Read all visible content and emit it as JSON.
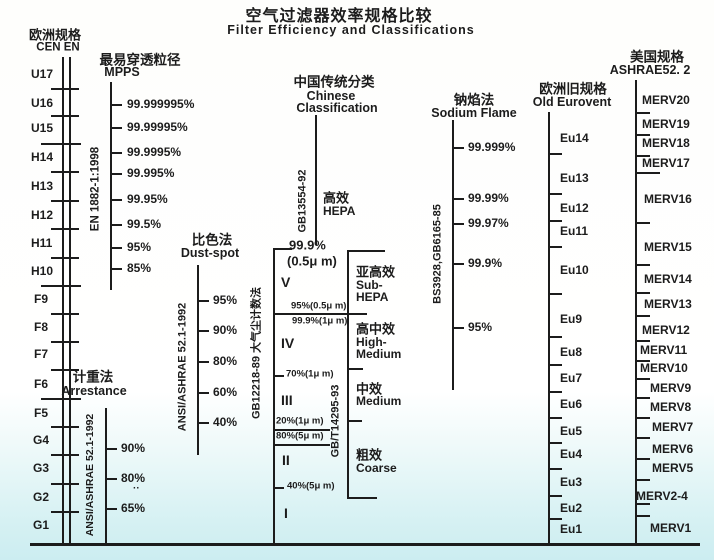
{
  "title": {
    "zh": "空气过滤器效率规格比较",
    "en": "Filter Efficiency and Classifications"
  },
  "colors": {
    "ink": "#1c1c1c",
    "bg_bottom": "#ccedf1",
    "bg_top": "#ffffff"
  },
  "baseline": {
    "y": 543,
    "x1": 30,
    "x2": 700
  },
  "scales": [
    {
      "id": "cen-en",
      "headers": [
        {
          "t": "欧洲规格",
          "cx": 55,
          "cy": 35,
          "s": 13
        },
        {
          "t": "CEN EN",
          "cx": 58,
          "cy": 48,
          "s": 11.5
        }
      ],
      "lines": [
        {
          "x": 62,
          "y1": 57,
          "y2": 543
        },
        {
          "x": 69,
          "y1": 57,
          "y2": 543
        }
      ],
      "labels": [
        {
          "t": "U17",
          "x": 31,
          "y": 74
        },
        {
          "t": "U16",
          "x": 31,
          "y": 103
        },
        {
          "t": "U15",
          "x": 31,
          "y": 128
        },
        {
          "t": "H14",
          "x": 31,
          "y": 157
        },
        {
          "t": "H13",
          "x": 31,
          "y": 186
        },
        {
          "t": "H12",
          "x": 31,
          "y": 215
        },
        {
          "t": "H11",
          "x": 31,
          "y": 243
        },
        {
          "t": "H10",
          "x": 31,
          "y": 271
        },
        {
          "t": "F9",
          "x": 34,
          "y": 299
        },
        {
          "t": "F8",
          "x": 34,
          "y": 327
        },
        {
          "t": "F7",
          "x": 34,
          "y": 354
        },
        {
          "t": "F6",
          "x": 34,
          "y": 384
        },
        {
          "t": "F5",
          "x": 34,
          "y": 413
        },
        {
          "t": "G4",
          "x": 33,
          "y": 440
        },
        {
          "t": "G3",
          "x": 33,
          "y": 468
        },
        {
          "t": "G2",
          "x": 33,
          "y": 497
        },
        {
          "t": "G1",
          "x": 33,
          "y": 525
        }
      ],
      "hlines": [
        {
          "y": 88,
          "x1": 51,
          "x2": 79
        },
        {
          "y": 115,
          "x1": 51,
          "x2": 79
        },
        {
          "y": 143,
          "x1": 41,
          "x2": 81
        },
        {
          "y": 171,
          "x1": 51,
          "x2": 79
        },
        {
          "y": 200,
          "x1": 51,
          "x2": 79
        },
        {
          "y": 228,
          "x1": 51,
          "x2": 79
        },
        {
          "y": 257,
          "x1": 51,
          "x2": 79
        },
        {
          "y": 285,
          "x1": 41,
          "x2": 81
        },
        {
          "y": 313,
          "x1": 51,
          "x2": 79
        },
        {
          "y": 341,
          "x1": 51,
          "x2": 79
        },
        {
          "y": 369,
          "x1": 51,
          "x2": 79
        },
        {
          "y": 398,
          "x1": 41,
          "x2": 81
        },
        {
          "y": 426,
          "x1": 51,
          "x2": 79
        },
        {
          "y": 454,
          "x1": 51,
          "x2": 79
        },
        {
          "y": 483,
          "x1": 51,
          "x2": 79
        },
        {
          "y": 511,
          "x1": 51,
          "x2": 79
        }
      ],
      "vtexts": []
    },
    {
      "id": "mpps",
      "headers": [
        {
          "t": "最易穿透粒径",
          "cx": 140,
          "cy": 60,
          "s": 13.5
        },
        {
          "t": "MPPS",
          "cx": 122,
          "cy": 72,
          "s": 12.5
        }
      ],
      "lines": [
        {
          "x": 110,
          "y1": 82,
          "y2": 290
        }
      ],
      "labels": [
        {
          "t": "99.999995%",
          "x": 127,
          "y": 104
        },
        {
          "t": "99.99995%",
          "x": 127,
          "y": 127
        },
        {
          "t": "99.9995%",
          "x": 127,
          "y": 152
        },
        {
          "t": "99.995%",
          "x": 127,
          "y": 173
        },
        {
          "t": "99.95%",
          "x": 127,
          "y": 199
        },
        {
          "t": "99.5%",
          "x": 127,
          "y": 224
        },
        {
          "t": "95%",
          "x": 127,
          "y": 247
        },
        {
          "t": "85%",
          "x": 127,
          "y": 268
        }
      ],
      "hlines": [
        {
          "y": 104,
          "x1": 110,
          "x2": 122
        },
        {
          "y": 127,
          "x1": 110,
          "x2": 122
        },
        {
          "y": 152,
          "x1": 110,
          "x2": 122
        },
        {
          "y": 173,
          "x1": 110,
          "x2": 122
        },
        {
          "y": 199,
          "x1": 110,
          "x2": 122
        },
        {
          "y": 224,
          "x1": 110,
          "x2": 122
        },
        {
          "y": 247,
          "x1": 110,
          "x2": 122
        },
        {
          "y": 268,
          "x1": 110,
          "x2": 122
        }
      ],
      "vtexts": [
        {
          "t": "EN 1882-1:1998",
          "cx": 96,
          "cy": 189,
          "s": 11.5
        }
      ]
    },
    {
      "id": "dust-spot",
      "headers": [
        {
          "t": "比色法",
          "cx": 212,
          "cy": 240,
          "s": 13.5
        },
        {
          "t": "Dust-spot",
          "cx": 210,
          "cy": 253,
          "s": 12.5
        }
      ],
      "lines": [
        {
          "x": 197,
          "y1": 265,
          "y2": 455
        }
      ],
      "labels": [
        {
          "t": "95%",
          "x": 213,
          "y": 300
        },
        {
          "t": "90%",
          "x": 213,
          "y": 330
        },
        {
          "t": "80%",
          "x": 213,
          "y": 361
        },
        {
          "t": "60%",
          "x": 213,
          "y": 392
        },
        {
          "t": "40%",
          "x": 213,
          "y": 422
        }
      ],
      "hlines": [
        {
          "y": 300,
          "x1": 197,
          "x2": 209
        },
        {
          "y": 330,
          "x1": 197,
          "x2": 209
        },
        {
          "y": 361,
          "x1": 197,
          "x2": 209
        },
        {
          "y": 392,
          "x1": 197,
          "x2": 209
        },
        {
          "y": 422,
          "x1": 197,
          "x2": 209
        }
      ],
      "vtexts": [
        {
          "t": "ANSI/ASHRAE 52.1-1992",
          "cx": 183,
          "cy": 367,
          "s": 11
        }
      ]
    },
    {
      "id": "arrestance",
      "headers": [
        {
          "t": "计重法",
          "cx": 93,
          "cy": 377,
          "s": 13.5
        },
        {
          "t": "Arrestance",
          "cx": 94,
          "cy": 391,
          "s": 12.5
        }
      ],
      "lines": [
        {
          "x": 105,
          "y1": 408,
          "y2": 543
        }
      ],
      "labels": [
        {
          "t": "90%",
          "x": 121,
          "y": 448
        },
        {
          "t": "80%",
          "x": 121,
          "y": 478
        },
        {
          "t": "··",
          "x": 133,
          "y": 489,
          "s": 10
        },
        {
          "t": "65%",
          "x": 121,
          "y": 508
        }
      ],
      "hlines": [
        {
          "y": 448,
          "x1": 105,
          "x2": 117
        },
        {
          "y": 478,
          "x1": 105,
          "x2": 117
        },
        {
          "y": 508,
          "x1": 105,
          "x2": 117
        }
      ],
      "vtexts": [
        {
          "t": "ANSI/ASHRAE 52.1-1992",
          "cx": 90,
          "cy": 475,
          "s": 10.5
        }
      ]
    },
    {
      "id": "chinese",
      "headers": [
        {
          "t": "中国传统分类",
          "cx": 334,
          "cy": 82,
          "s": 13.5
        },
        {
          "t": "Chinese",
          "cx": 331,
          "cy": 96,
          "s": 12.5
        },
        {
          "t": "Classification",
          "cx": 337,
          "cy": 108,
          "s": 12.5
        }
      ],
      "lines": [
        {
          "x": 315,
          "y1": 115,
          "y2": 245
        },
        {
          "x": 273,
          "y1": 248,
          "y2": 543
        },
        {
          "x": 347,
          "y1": 250,
          "y2": 497
        }
      ],
      "labels": [
        {
          "t": "高效",
          "x": 323,
          "y": 198,
          "s": 13
        },
        {
          "t": "HEPA",
          "x": 323,
          "y": 211
        },
        {
          "t": "99.9%",
          "x": 289,
          "y": 245,
          "s": 13
        },
        {
          "t": "(0.5μ m)",
          "x": 287,
          "y": 261,
          "s": 13
        },
        {
          "t": "V",
          "x": 281,
          "y": 282,
          "s": 14
        },
        {
          "t": "95%(0.5μ m)",
          "x": 291,
          "y": 306,
          "s": 9.5
        },
        {
          "t": "99.9%(1μ m)",
          "x": 292,
          "y": 321,
          "s": 9.5
        },
        {
          "t": "IV",
          "x": 281,
          "y": 343,
          "s": 14
        },
        {
          "t": "70%(1μ m)",
          "x": 286,
          "y": 374,
          "s": 9.5
        },
        {
          "t": "III",
          "x": 281,
          "y": 400,
          "s": 14
        },
        {
          "t": "20%(1μ m)",
          "x": 276,
          "y": 421,
          "s": 9.5
        },
        {
          "t": "80%(5μ m)",
          "x": 276,
          "y": 436,
          "s": 9.5
        },
        {
          "t": "II",
          "x": 282,
          "y": 460,
          "s": 14
        },
        {
          "t": "40%(5μ m)",
          "x": 287,
          "y": 486,
          "s": 9.5
        },
        {
          "t": "I",
          "x": 284,
          "y": 513,
          "s": 14
        },
        {
          "t": "亚高效",
          "x": 356,
          "y": 272,
          "s": 13
        },
        {
          "t": "Sub-",
          "x": 356,
          "y": 285
        },
        {
          "t": "HEPA",
          "x": 356,
          "y": 297
        },
        {
          "t": "高中效",
          "x": 356,
          "y": 329,
          "s": 13
        },
        {
          "t": "High-",
          "x": 356,
          "y": 342
        },
        {
          "t": "Medium",
          "x": 356,
          "y": 354
        },
        {
          "t": "中效",
          "x": 356,
          "y": 389,
          "s": 13
        },
        {
          "t": "Medium",
          "x": 356,
          "y": 401
        },
        {
          "t": "粗效",
          "x": 356,
          "y": 455,
          "s": 13
        },
        {
          "t": "Coarse",
          "x": 356,
          "y": 468
        }
      ],
      "hlines": [
        {
          "y": 248,
          "x1": 273,
          "x2": 292
        },
        {
          "y": 250,
          "x1": 347,
          "x2": 385
        },
        {
          "y": 313,
          "x1": 273,
          "x2": 367
        },
        {
          "y": 368,
          "x1": 347,
          "x2": 363
        },
        {
          "y": 375,
          "x1": 273,
          "x2": 284
        },
        {
          "y": 420,
          "x1": 347,
          "x2": 362
        },
        {
          "y": 429,
          "x1": 273,
          "x2": 330
        },
        {
          "y": 444,
          "x1": 273,
          "x2": 330
        },
        {
          "y": 487,
          "x1": 273,
          "x2": 284
        },
        {
          "y": 497,
          "x1": 347,
          "x2": 377
        }
      ],
      "vtexts": [
        {
          "t": "GB13554-92",
          "cx": 303,
          "cy": 201,
          "s": 11
        },
        {
          "t": "GB12218-89  大气尘计数法",
          "cx": 257,
          "cy": 353,
          "s": 11
        },
        {
          "t": "GB/T14295-93",
          "cx": 336,
          "cy": 421,
          "s": 11
        }
      ]
    },
    {
      "id": "sodium-flame",
      "headers": [
        {
          "t": "钠焰法",
          "cx": 474,
          "cy": 100,
          "s": 13.5
        },
        {
          "t": "Sodium Flame",
          "cx": 474,
          "cy": 113,
          "s": 12.5
        }
      ],
      "lines": [
        {
          "x": 452,
          "y1": 120,
          "y2": 390
        }
      ],
      "labels": [
        {
          "t": "99.999%",
          "x": 468,
          "y": 147
        },
        {
          "t": "99.99%",
          "x": 468,
          "y": 198
        },
        {
          "t": "99.97%",
          "x": 468,
          "y": 223
        },
        {
          "t": "99.9%",
          "x": 468,
          "y": 263
        },
        {
          "t": "95%",
          "x": 468,
          "y": 327
        }
      ],
      "hlines": [
        {
          "y": 147,
          "x1": 452,
          "x2": 464
        },
        {
          "y": 198,
          "x1": 452,
          "x2": 464
        },
        {
          "y": 223,
          "x1": 452,
          "x2": 464
        },
        {
          "y": 263,
          "x1": 452,
          "x2": 464
        },
        {
          "y": 327,
          "x1": 452,
          "x2": 464
        }
      ],
      "vtexts": [
        {
          "t": "BS3928,GB6165-85",
          "cx": 438,
          "cy": 254,
          "s": 11
        }
      ]
    },
    {
      "id": "old-eurovent",
      "headers": [
        {
          "t": "欧洲旧规格",
          "cx": 573,
          "cy": 89,
          "s": 13.5
        },
        {
          "t": "Old Eurovent",
          "cx": 572,
          "cy": 102,
          "s": 12.5
        }
      ],
      "lines": [
        {
          "x": 548,
          "y1": 112,
          "y2": 543
        }
      ],
      "labels": [
        {
          "t": "Eu14",
          "x": 560,
          "y": 138
        },
        {
          "t": "Eu13",
          "x": 560,
          "y": 178
        },
        {
          "t": "Eu12",
          "x": 560,
          "y": 208
        },
        {
          "t": "Eu11",
          "x": 560,
          "y": 231
        },
        {
          "t": "Eu10",
          "x": 560,
          "y": 270
        },
        {
          "t": "Eu9",
          "x": 560,
          "y": 319
        },
        {
          "t": "Eu8",
          "x": 560,
          "y": 352
        },
        {
          "t": "Eu7",
          "x": 560,
          "y": 378
        },
        {
          "t": "Eu6",
          "x": 560,
          "y": 404
        },
        {
          "t": "Eu5",
          "x": 560,
          "y": 431
        },
        {
          "t": "Eu4",
          "x": 560,
          "y": 454
        },
        {
          "t": "Eu3",
          "x": 560,
          "y": 482
        },
        {
          "t": "Eu2",
          "x": 560,
          "y": 508
        },
        {
          "t": "Eu1",
          "x": 560,
          "y": 529
        }
      ],
      "hlines": [
        {
          "y": 153,
          "x1": 548,
          "x2": 562
        },
        {
          "y": 193,
          "x1": 548,
          "x2": 562
        },
        {
          "y": 220,
          "x1": 548,
          "x2": 562
        },
        {
          "y": 246,
          "x1": 548,
          "x2": 562
        },
        {
          "y": 293,
          "x1": 548,
          "x2": 562
        },
        {
          "y": 336,
          "x1": 548,
          "x2": 562
        },
        {
          "y": 364,
          "x1": 548,
          "x2": 562
        },
        {
          "y": 391,
          "x1": 548,
          "x2": 562
        },
        {
          "y": 417,
          "x1": 548,
          "x2": 562
        },
        {
          "y": 442,
          "x1": 548,
          "x2": 562
        },
        {
          "y": 468,
          "x1": 548,
          "x2": 562
        },
        {
          "y": 495,
          "x1": 548,
          "x2": 562
        },
        {
          "y": 518,
          "x1": 548,
          "x2": 562
        }
      ],
      "vtexts": []
    },
    {
      "id": "ashrae-merv",
      "headers": [
        {
          "t": "美国规格",
          "cx": 657,
          "cy": 57,
          "s": 13.5
        },
        {
          "t": "ASHRAE52. 2",
          "cx": 650,
          "cy": 70,
          "s": 12.5
        }
      ],
      "lines": [
        {
          "x": 635,
          "y1": 80,
          "y2": 543
        }
      ],
      "labels": [
        {
          "t": "MERV20",
          "x": 642,
          "y": 100
        },
        {
          "t": "MERV19",
          "x": 642,
          "y": 124
        },
        {
          "t": "MERV18",
          "x": 642,
          "y": 143
        },
        {
          "t": "MERV17",
          "x": 642,
          "y": 163
        },
        {
          "t": "MERV16",
          "x": 644,
          "y": 199
        },
        {
          "t": "MERV15",
          "x": 644,
          "y": 247
        },
        {
          "t": "MERV14",
          "x": 644,
          "y": 279
        },
        {
          "t": "MERV13",
          "x": 644,
          "y": 304
        },
        {
          "t": "MERV12",
          "x": 642,
          "y": 330
        },
        {
          "t": "MERV11",
          "x": 640,
          "y": 350
        },
        {
          "t": "MERV10",
          "x": 640,
          "y": 368
        },
        {
          "t": "MERV9",
          "x": 650,
          "y": 388
        },
        {
          "t": "MERV8",
          "x": 650,
          "y": 407
        },
        {
          "t": "MERV7",
          "x": 652,
          "y": 427
        },
        {
          "t": "MERV6",
          "x": 652,
          "y": 449
        },
        {
          "t": "MERV5",
          "x": 652,
          "y": 468
        },
        {
          "t": "MERV2-4",
          "x": 636,
          "y": 496
        },
        {
          "t": "MERV1",
          "x": 650,
          "y": 528
        }
      ],
      "hlines": [
        {
          "y": 112,
          "x1": 635,
          "x2": 650
        },
        {
          "y": 134,
          "x1": 635,
          "x2": 650
        },
        {
          "y": 155,
          "x1": 635,
          "x2": 650
        },
        {
          "y": 172,
          "x1": 635,
          "x2": 660
        },
        {
          "y": 222,
          "x1": 635,
          "x2": 650
        },
        {
          "y": 264,
          "x1": 635,
          "x2": 650
        },
        {
          "y": 292,
          "x1": 635,
          "x2": 650
        },
        {
          "y": 315,
          "x1": 635,
          "x2": 650
        },
        {
          "y": 340,
          "x1": 635,
          "x2": 650
        },
        {
          "y": 360,
          "x1": 635,
          "x2": 650
        },
        {
          "y": 378,
          "x1": 635,
          "x2": 650
        },
        {
          "y": 397,
          "x1": 635,
          "x2": 650
        },
        {
          "y": 417,
          "x1": 635,
          "x2": 650
        },
        {
          "y": 437,
          "x1": 635,
          "x2": 650
        },
        {
          "y": 458,
          "x1": 635,
          "x2": 650
        },
        {
          "y": 479,
          "x1": 635,
          "x2": 650
        },
        {
          "y": 503,
          "x1": 635,
          "x2": 650
        },
        {
          "y": 515,
          "x1": 635,
          "x2": 650
        }
      ],
      "vtexts": []
    }
  ]
}
